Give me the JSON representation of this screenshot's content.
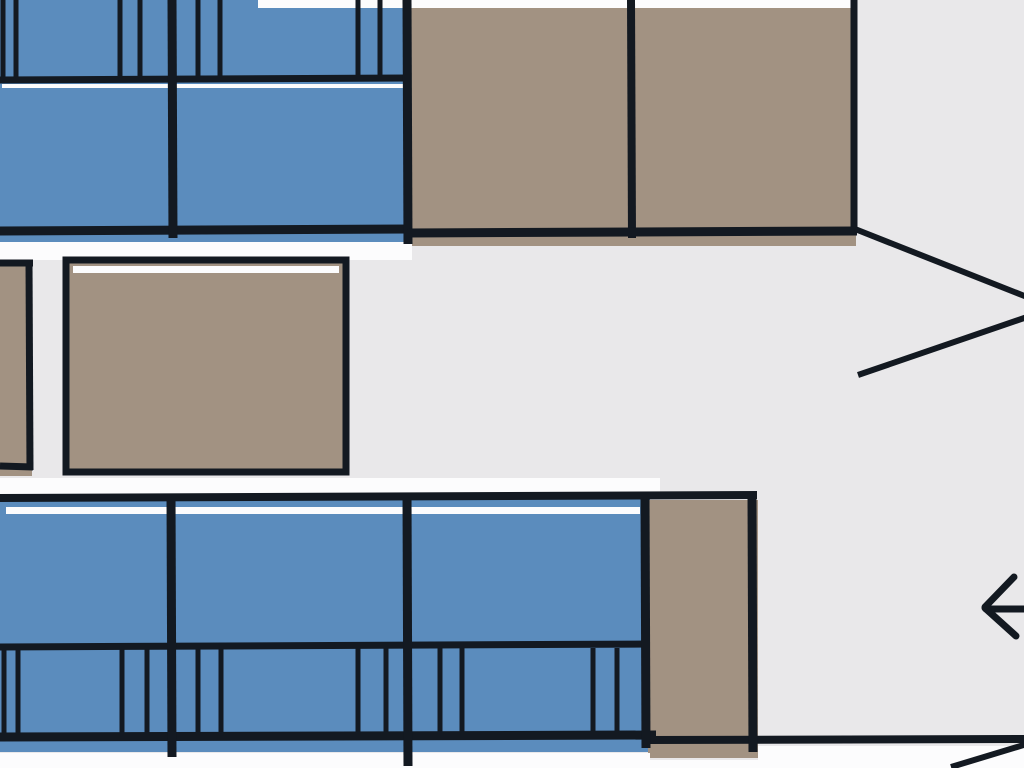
{
  "figure": {
    "kind": "hand-drawn vehicle seat map (partial, zoomed crop)",
    "orientation": "pointed end at right, direction arrow pointing left"
  },
  "canvas": {
    "width": 1024,
    "height": 768,
    "background": "#e9e8ea"
  },
  "palette": {
    "background": "#e9e8ea",
    "seat": "#5b8cbd",
    "table": "#a29282",
    "line": "#131921",
    "halo": "#fcfcfd"
  },
  "shapes": [
    {
      "k": "rect",
      "name": "seat-bench-top-fill",
      "x": 0,
      "y": 0,
      "w": 408,
      "h": 246,
      "fill": "seat"
    },
    {
      "k": "rect",
      "name": "table-top-fill",
      "x": 408,
      "y": 6,
      "w": 448,
      "h": 240,
      "fill": "table"
    },
    {
      "k": "rect",
      "name": "counter-left-fill",
      "x": 0,
      "y": 264,
      "w": 32,
      "h": 212,
      "fill": "table"
    },
    {
      "k": "rect",
      "name": "seat-bench-bottom-fill",
      "x": 0,
      "y": 498,
      "w": 650,
      "h": 254,
      "fill": "seat"
    },
    {
      "k": "rect",
      "name": "table-bottom-fill",
      "x": 648,
      "y": 500,
      "w": 110,
      "h": 258,
      "fill": "table"
    },
    {
      "k": "rect",
      "name": "halo-top-edge",
      "x": 258,
      "y": 0,
      "w": 598,
      "h": 8,
      "fill": "halo"
    },
    {
      "k": "rect",
      "name": "halo-under-top-seats",
      "x": 0,
      "y": 242,
      "w": 412,
      "h": 18,
      "fill": "halo"
    },
    {
      "k": "rect",
      "name": "halo-above-bottom-seats",
      "x": 0,
      "y": 478,
      "w": 660,
      "h": 19,
      "fill": "halo"
    },
    {
      "k": "rect",
      "name": "halo-bottom-left",
      "x": 0,
      "y": 753,
      "w": 650,
      "h": 15,
      "fill": "halo"
    },
    {
      "k": "rect",
      "name": "halo-bottom-right",
      "x": 758,
      "y": 746,
      "w": 266,
      "h": 22,
      "fill": "halo"
    },
    {
      "k": "rect",
      "name": "halo-under-bottom-table",
      "x": 650,
      "y": 760,
      "w": 110,
      "h": 8,
      "fill": "halo"
    },
    {
      "k": "rect",
      "name": "table-mid-left",
      "x": 66,
      "y": 260,
      "w": 280,
      "h": 212,
      "fill": "table",
      "stroke": "line",
      "sw": 7
    },
    {
      "k": "rect",
      "name": "table-mid-left-highlight",
      "x": 73,
      "y": 266,
      "w": 266,
      "h": 7,
      "fill": "halo"
    },
    {
      "k": "rect",
      "name": "seat-top-cushion-highlight",
      "x": 2,
      "y": 84,
      "w": 402,
      "h": 4,
      "fill": "halo"
    },
    {
      "k": "rect",
      "name": "seat-bottom-cushion-highlight",
      "x": 6,
      "y": 507,
      "w": 634,
      "h": 7,
      "fill": "halo"
    },
    {
      "k": "line",
      "name": "top-backrest-bottom-line",
      "x1": 0,
      "y1": 80,
      "x2": 408,
      "y2": 78,
      "sw": 7
    },
    {
      "k": "line",
      "name": "top-cushion-bottom-line",
      "x1": 0,
      "y1": 231,
      "x2": 410,
      "y2": 229,
      "sw": 9
    },
    {
      "k": "line",
      "name": "top-seat-divider",
      "x1": 172,
      "y1": 0,
      "x2": 173,
      "y2": 238,
      "sw": 9
    },
    {
      "k": "line",
      "name": "top-seat-table-divider",
      "x1": 407,
      "y1": 0,
      "x2": 408,
      "y2": 244,
      "sw": 9
    },
    {
      "k": "line",
      "name": "top-table-divider",
      "x1": 631,
      "y1": 0,
      "x2": 632,
      "y2": 238,
      "sw": 8
    },
    {
      "k": "line",
      "name": "top-table-right-edge",
      "x1": 854,
      "y1": 0,
      "x2": 854,
      "y2": 231,
      "sw": 7
    },
    {
      "k": "line",
      "name": "top-table-bottom-line",
      "x1": 408,
      "y1": 233,
      "x2": 857,
      "y2": 231,
      "sw": 9
    },
    {
      "k": "line",
      "name": "top-backrest-tick",
      "x1": 3,
      "y1": 0,
      "x2": 3,
      "y2": 80,
      "sw": 5
    },
    {
      "k": "line",
      "name": "top-backrest-tick",
      "x1": 16,
      "y1": 0,
      "x2": 16,
      "y2": 80,
      "sw": 5
    },
    {
      "k": "line",
      "name": "top-backrest-tick",
      "x1": 120,
      "y1": 0,
      "x2": 120,
      "y2": 80,
      "sw": 5
    },
    {
      "k": "line",
      "name": "top-backrest-tick",
      "x1": 140,
      "y1": 0,
      "x2": 140,
      "y2": 80,
      "sw": 5
    },
    {
      "k": "line",
      "name": "top-backrest-tick",
      "x1": 198,
      "y1": 0,
      "x2": 198,
      "y2": 82,
      "sw": 5
    },
    {
      "k": "line",
      "name": "top-backrest-tick",
      "x1": 220,
      "y1": 0,
      "x2": 220,
      "y2": 82,
      "sw": 5
    },
    {
      "k": "line",
      "name": "top-backrest-tick",
      "x1": 358,
      "y1": 0,
      "x2": 358,
      "y2": 80,
      "sw": 5
    },
    {
      "k": "line",
      "name": "top-backrest-tick",
      "x1": 380,
      "y1": 0,
      "x2": 380,
      "y2": 80,
      "sw": 5
    },
    {
      "k": "line",
      "name": "counter-left-top-line",
      "x1": 0,
      "y1": 263,
      "x2": 33,
      "y2": 263,
      "sw": 7
    },
    {
      "k": "line",
      "name": "counter-left-right-edge",
      "x1": 29,
      "y1": 261,
      "x2": 30,
      "y2": 470,
      "sw": 7
    },
    {
      "k": "line",
      "name": "counter-left-bottom-line",
      "x1": 0,
      "y1": 466,
      "x2": 33,
      "y2": 467,
      "sw": 7
    },
    {
      "k": "line",
      "name": "nose-upper-diagonal",
      "x1": 855,
      "y1": 229,
      "x2": 1027,
      "y2": 297,
      "sw": 6
    },
    {
      "k": "line",
      "name": "nose-lower-diagonal",
      "x1": 858,
      "y1": 375,
      "x2": 1027,
      "y2": 317,
      "sw": 6
    },
    {
      "k": "line",
      "name": "bottom-row-top-line",
      "x1": 0,
      "y1": 498,
      "x2": 757,
      "y2": 495,
      "sw": 8
    },
    {
      "k": "line",
      "name": "bottom-cushion-bottom-line",
      "x1": 0,
      "y1": 647,
      "x2": 650,
      "y2": 644,
      "sw": 7
    },
    {
      "k": "line",
      "name": "bottom-backrest-bottom-line",
      "x1": 0,
      "y1": 737,
      "x2": 656,
      "y2": 735,
      "sw": 9
    },
    {
      "k": "line",
      "name": "bottom-wall-line",
      "x1": 648,
      "y1": 740,
      "x2": 1027,
      "y2": 739,
      "sw": 8
    },
    {
      "k": "line",
      "name": "bottom-seat-divider-1",
      "x1": 171,
      "y1": 496,
      "x2": 172,
      "y2": 757,
      "sw": 9
    },
    {
      "k": "line",
      "name": "bottom-seat-divider-2",
      "x1": 407,
      "y1": 496,
      "x2": 408,
      "y2": 766,
      "sw": 9
    },
    {
      "k": "line",
      "name": "bottom-seat-table-edge",
      "x1": 645,
      "y1": 496,
      "x2": 646,
      "y2": 748,
      "sw": 9
    },
    {
      "k": "line",
      "name": "bottom-table-right-edge",
      "x1": 752,
      "y1": 496,
      "x2": 753,
      "y2": 752,
      "sw": 9
    },
    {
      "k": "line",
      "name": "bottom-backrest-tick",
      "x1": 4,
      "y1": 648,
      "x2": 4,
      "y2": 736,
      "sw": 5
    },
    {
      "k": "line",
      "name": "bottom-backrest-tick",
      "x1": 18,
      "y1": 648,
      "x2": 18,
      "y2": 736,
      "sw": 5
    },
    {
      "k": "line",
      "name": "bottom-backrest-tick",
      "x1": 122,
      "y1": 648,
      "x2": 122,
      "y2": 736,
      "sw": 5
    },
    {
      "k": "line",
      "name": "bottom-backrest-tick",
      "x1": 147,
      "y1": 648,
      "x2": 147,
      "y2": 736,
      "sw": 5
    },
    {
      "k": "line",
      "name": "bottom-backrest-tick",
      "x1": 198,
      "y1": 648,
      "x2": 198,
      "y2": 736,
      "sw": 5
    },
    {
      "k": "line",
      "name": "bottom-backrest-tick",
      "x1": 221,
      "y1": 648,
      "x2": 221,
      "y2": 736,
      "sw": 5
    },
    {
      "k": "line",
      "name": "bottom-backrest-tick",
      "x1": 358,
      "y1": 648,
      "x2": 358,
      "y2": 736,
      "sw": 5
    },
    {
      "k": "line",
      "name": "bottom-backrest-tick",
      "x1": 386,
      "y1": 648,
      "x2": 386,
      "y2": 736,
      "sw": 5
    },
    {
      "k": "line",
      "name": "bottom-backrest-tick",
      "x1": 440,
      "y1": 648,
      "x2": 440,
      "y2": 736,
      "sw": 5
    },
    {
      "k": "line",
      "name": "bottom-backrest-tick",
      "x1": 462,
      "y1": 648,
      "x2": 462,
      "y2": 736,
      "sw": 5
    },
    {
      "k": "line",
      "name": "bottom-backrest-tick",
      "x1": 593,
      "y1": 648,
      "x2": 593,
      "y2": 736,
      "sw": 5
    },
    {
      "k": "line",
      "name": "bottom-backrest-tick",
      "x1": 617,
      "y1": 648,
      "x2": 617,
      "y2": 736,
      "sw": 5
    },
    {
      "k": "line",
      "name": "corner-diagonal",
      "x1": 951,
      "y1": 767,
      "x2": 1027,
      "y2": 744,
      "sw": 6
    },
    {
      "k": "line",
      "name": "direction-arrow-shaft",
      "x1": 986,
      "y1": 609,
      "x2": 1026,
      "y2": 609,
      "sw": 7,
      "cap": "round"
    },
    {
      "k": "line",
      "name": "direction-arrow-upper-arm",
      "x1": 985,
      "y1": 607,
      "x2": 1014,
      "y2": 577,
      "sw": 7,
      "cap": "round"
    },
    {
      "k": "line",
      "name": "direction-arrow-lower-arm",
      "x1": 985,
      "y1": 608,
      "x2": 1016,
      "y2": 636,
      "sw": 7,
      "cap": "round"
    }
  ]
}
